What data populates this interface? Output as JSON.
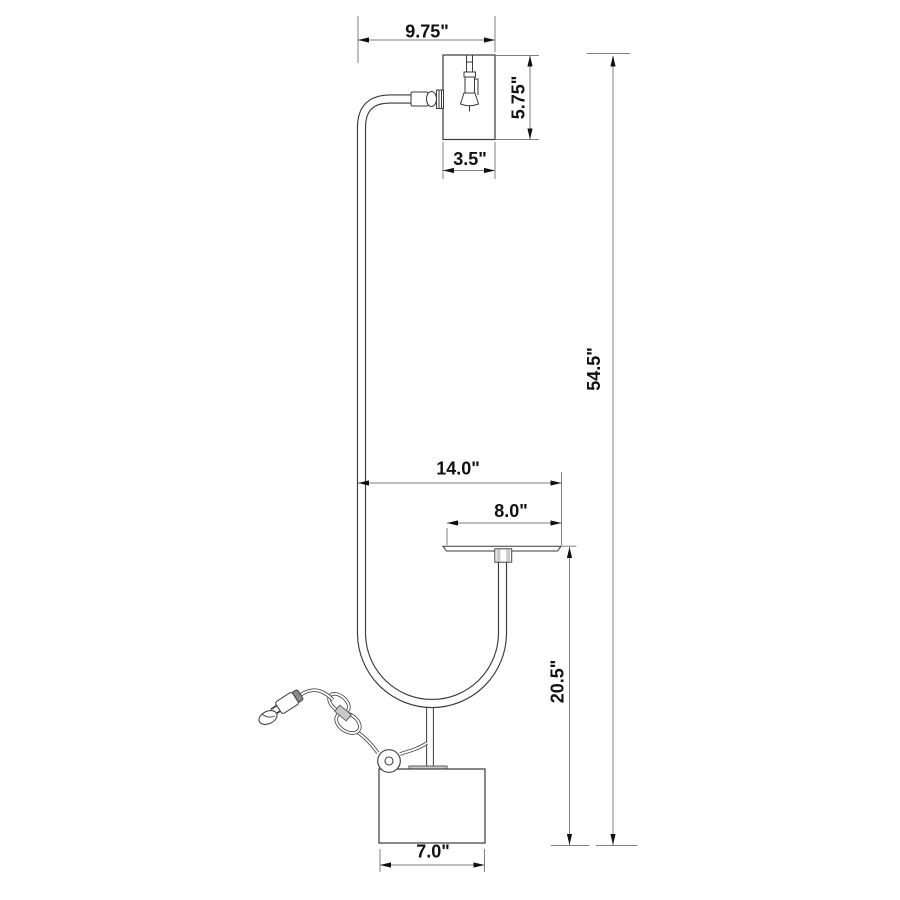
{
  "diagram": {
    "type": "product-dimension-drawing",
    "subject": "arc floor lamp with tray table, shade, cylindrical base and power cord",
    "dimensions": {
      "head_overhang_width": "9.75\"",
      "shade_height": "5.75\"",
      "shade_width": "3.5\"",
      "overall_height": "54.5\"",
      "arm_to_tray_width": "14.0\"",
      "tray_width": "8.0\"",
      "tray_to_floor_height": "20.5\"",
      "base_width": "7.0\""
    },
    "colors": {
      "background": "#ffffff",
      "object_line": "#3a3a3a",
      "dimension_line": "#7f7f7f",
      "text": "#111111",
      "shading": "#c9c9c9"
    }
  }
}
